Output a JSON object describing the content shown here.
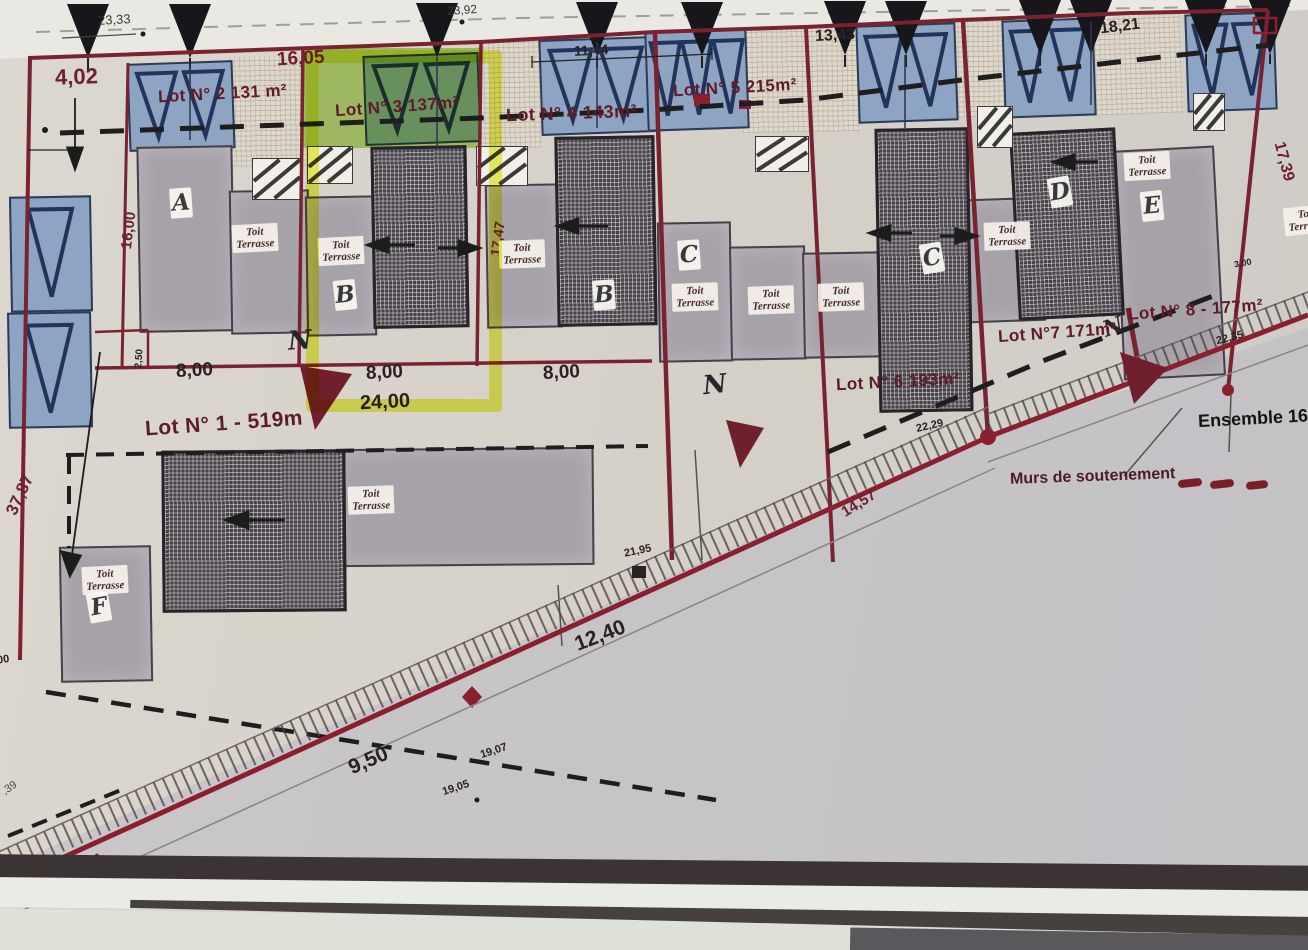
{
  "plan": {
    "lots": {
      "lot1": "Lot N° 1 - 519m",
      "lot2": "Lot N° 2 131 m²",
      "lot3": "Lot N° 3 137m²",
      "lot4": "Lot N° 4 143m²",
      "lot5": "Lot N° 5 215m²",
      "lot6": "Lot N° 6 193m²",
      "lot7": "Lot N°7 171m²",
      "lot8": "Lot N° 8 - 177m²"
    },
    "ensemble": "Ensemble 168",
    "legend": {
      "murs": "Murs de soutenement"
    },
    "north": "N",
    "buildings": {
      "a": "A",
      "b": "B",
      "c": "C",
      "d": "D",
      "e": "E",
      "f": "F"
    },
    "roof": {
      "line1": "Toit",
      "line2": "Terrasse"
    },
    "dims": {
      "d23_33": "23,33",
      "d23_92": "23,92",
      "d4_02": "4,02",
      "d16_05": "16,05",
      "d11_44": "11,44",
      "d13_43": "13,43",
      "d18_21": "18,21",
      "d17_39": "17,39",
      "d16_00": "16,00",
      "d37_87": "37,87",
      "d17_47": "17,47",
      "d8_00": "8,00",
      "d24_00": "24,00",
      "d2_50": "2,50",
      "d3_00": "3,00",
      "d_00": ",00",
      "d22_35": "22,35",
      "d22_29": "22,29",
      "d14_57": "14,57",
      "d21_95": "21,95",
      "d12_40": "12,40",
      "d9_50": "9,50",
      "d19_05": "19,05",
      "d19_07": "19,07",
      "d_39": ",39",
      "d11": "11"
    },
    "colors": {
      "boundary": "#7a2330",
      "highlight": "#e8f23c",
      "parking_blue": "#8da5c3",
      "building_grey": "#a7a1a9",
      "paper": "#d7d3ca",
      "road_red": "#8a1f2d"
    }
  }
}
